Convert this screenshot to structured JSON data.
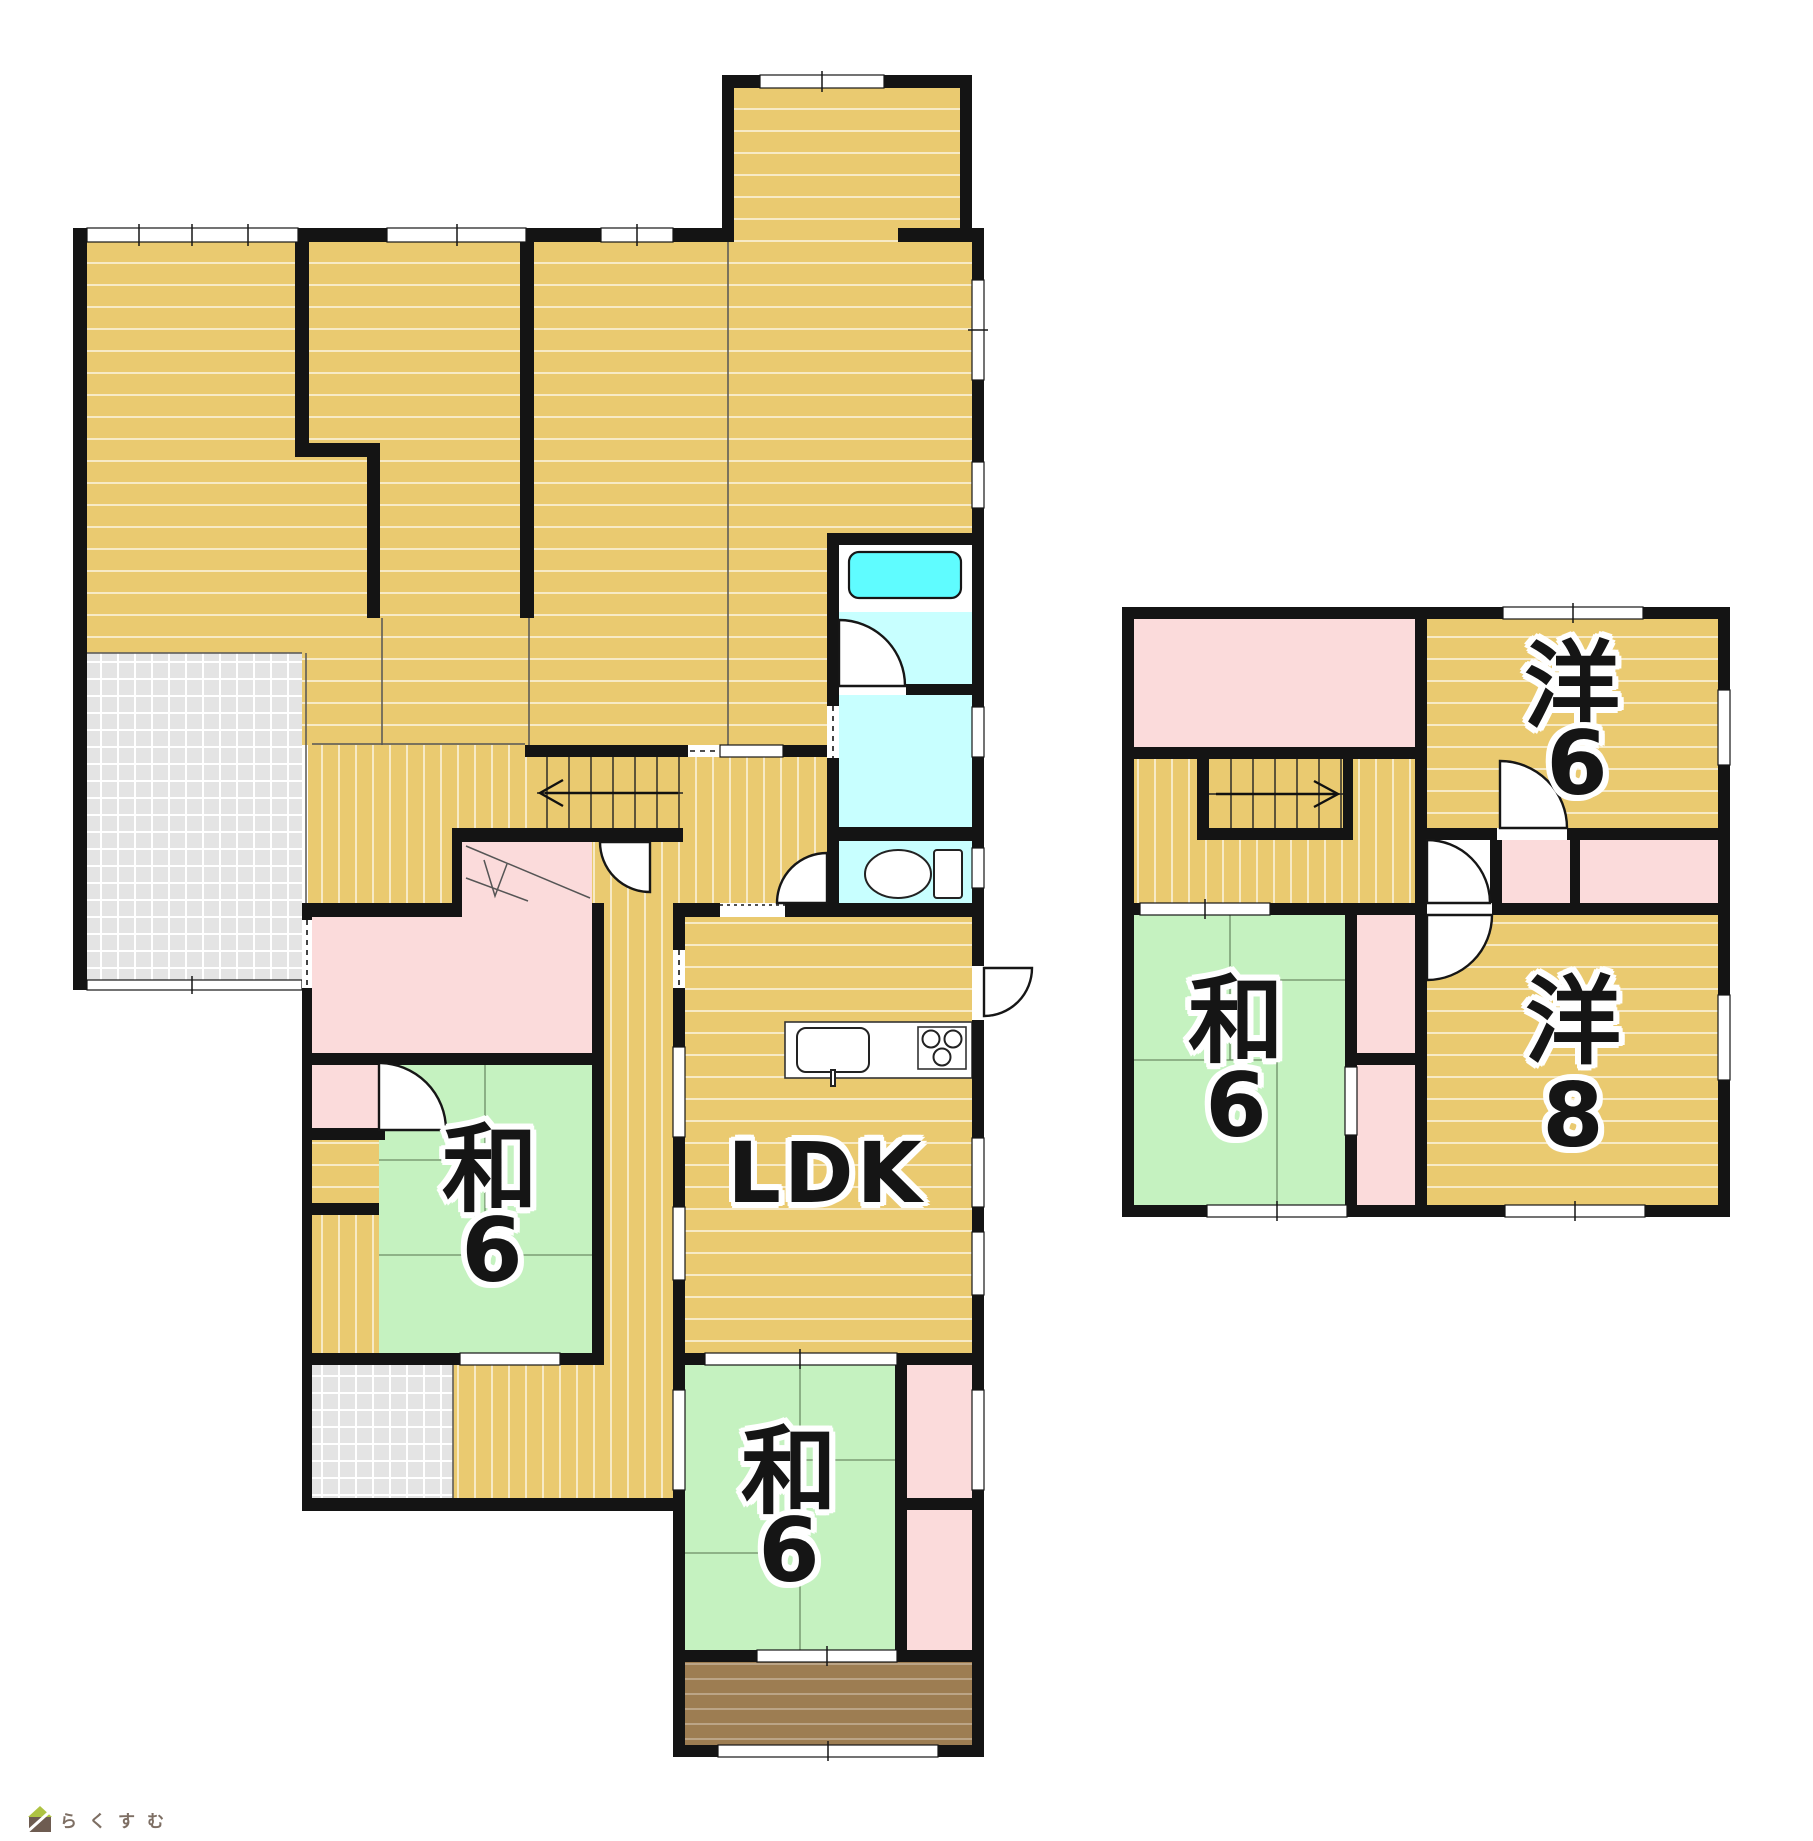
{
  "palette": {
    "wall": "#141414",
    "floor-wood": "#EACA70",
    "floor-line": "rgba(255,255,255,0.6)",
    "tatami-green": "#C5F2C0",
    "closet-pink": "#FBDBDB",
    "bath-cyan": "#C8FFFF",
    "bathtub-cyan": "#5FFCFF",
    "terrace-gray": "#E4E4E4",
    "porch-brown": "#9D7D52"
  },
  "floor1": {
    "ldk": "LDK",
    "washitsu_west": {
      "kanji": "和",
      "size": "6"
    },
    "washitsu_south": {
      "kanji": "和",
      "size": "6"
    }
  },
  "floor2": {
    "youshitsu6": {
      "kanji": "洋",
      "size": "6"
    },
    "washitsu": {
      "kanji": "和",
      "size": "6"
    },
    "youshitsu8": {
      "kanji": "洋",
      "size": "8"
    }
  },
  "logo": {
    "text": "らくすむ"
  }
}
